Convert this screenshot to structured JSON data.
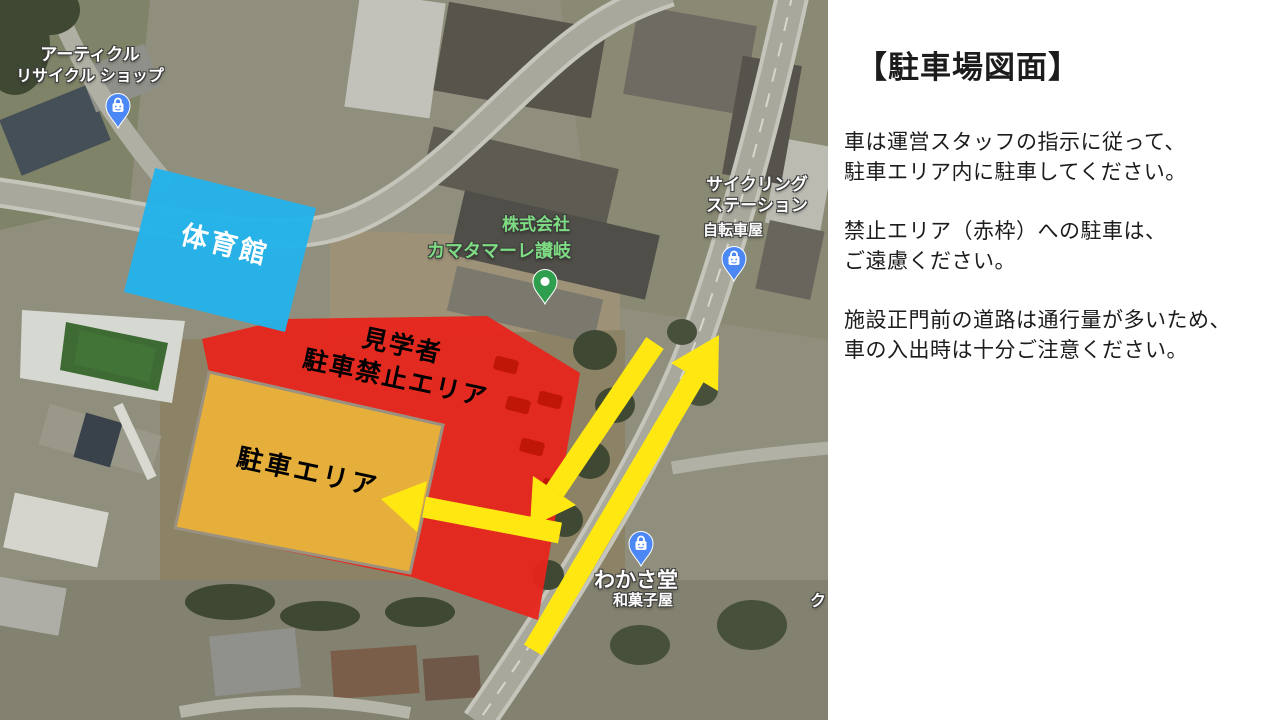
{
  "panel": {
    "title": "【駐車場図面】",
    "paragraphs": [
      {
        "line1": "車は運営スタッフの指示に従って、",
        "line2": "駐車エリア内に駐車してください。"
      },
      {
        "line1": "禁止エリア（赤枠）への駐車は、",
        "line2": "ご遠慮ください。"
      },
      {
        "line1": "施設正門前の道路は通行量が多いため、",
        "line2": "車の入出時は十分ご注意ください。"
      }
    ]
  },
  "map": {
    "zones": {
      "gym": {
        "label": "体育館",
        "color": "#23b3ea"
      },
      "no_parking": {
        "line1": "見学者",
        "line2": "駐車禁止エリア",
        "color": "#e8251c"
      },
      "parking": {
        "label": "駐車エリア",
        "color": "#e6b43c"
      }
    },
    "route_arrow_color": "#ffe812",
    "pois": {
      "recycle_shop": {
        "line1": "アーティクル",
        "line2": "リサイクル ショップ",
        "pin_color": "#4b87f5"
      },
      "kamatamare": {
        "line1": "株式会社",
        "line2": "カマタマーレ讃岐",
        "pin_color": "#2f9e4f",
        "label_color": "#7edc82"
      },
      "cycling_station": {
        "line1": "サイクリング",
        "line2": "ステーション",
        "line3": "自転車屋",
        "pin_color": "#4b87f5"
      },
      "wakasado": {
        "line1": "わかさ堂",
        "line2": "和菓子屋",
        "pin_color": "#4b87f5"
      },
      "edge_partial": {
        "text": "ク"
      }
    }
  }
}
